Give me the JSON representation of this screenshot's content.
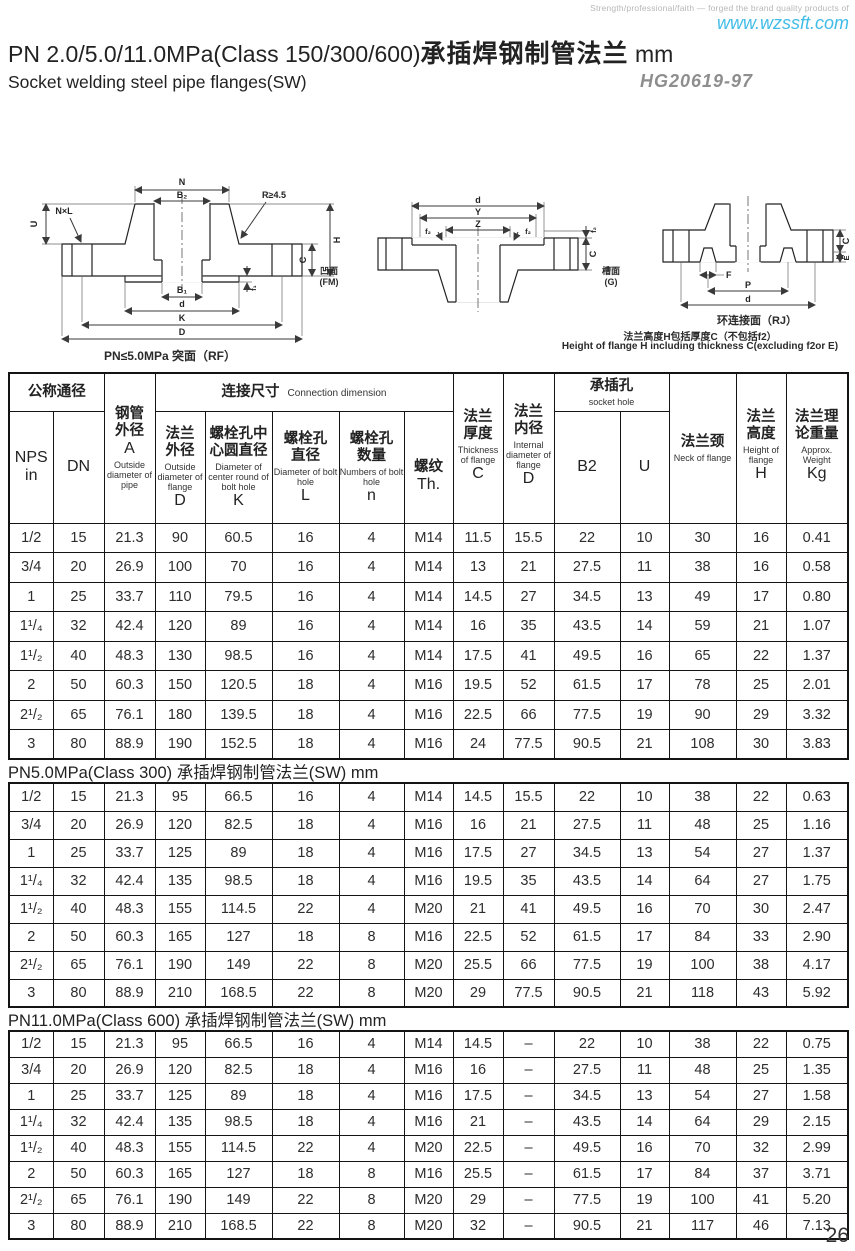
{
  "page": {
    "tagline": "Strength/professional/faith — forged the brand quality products of",
    "website": "www.wzssft.com",
    "title_en": "PN 2.0/5.0/11.0MPa(Class 150/300/600)",
    "title_cn": "承插焊钢制管法兰",
    "title_suffix": " mm",
    "subtitle": "Socket welding steel pipe flanges(SW)",
    "standard": "HG20619-97",
    "page_number": "26"
  },
  "colors": {
    "accent": "#41bce8",
    "muted": "#8e8e8e",
    "ink": "#262626"
  },
  "diagrams": {
    "rf": {
      "caption": "PN≤5.0MPa 突面（RF）",
      "dims": {
        "n": "N",
        "b2": "B₂",
        "nxl": "N×L",
        "r": "R≥4.5",
        "u": "U",
        "h": "H",
        "c": "C",
        "f1": "f₁",
        "b1": "B₁",
        "d": "d",
        "k": "K",
        "dd": "D"
      }
    },
    "fmg": {
      "dims": {
        "d": "d",
        "y": "Y",
        "z": "Z",
        "f2": "f₂",
        "c": "C"
      },
      "left_face_cn": "凹面",
      "left_face_code": "(FM)",
      "right_face_cn": "槽面",
      "right_face_code": "(G)"
    },
    "rj": {
      "caption": "环连接面（RJ）",
      "dims": {
        "c": "C",
        "e": "E",
        "f": "F",
        "p": "P",
        "d": "d"
      },
      "note_cn": "法兰高度H包括厚度C（不包括f2）",
      "note_en": "Height of flange H including thickness C(excluding f2or E)"
    }
  },
  "table": {
    "header": {
      "nominal_cn": "公称通径",
      "nps_l1": "NPS",
      "nps_l2": "in",
      "dn": "DN",
      "pipe_cn": "钢管\n外径",
      "pipe_letter": "A",
      "pipe_en": "Outside diameter of pipe",
      "conn_cn": "连接尺寸",
      "conn_en": "Connection dimension",
      "d_cn": "法兰\n外径",
      "d_en": "Outside diameter of flange",
      "d_letter": "D",
      "k_cn": "螺栓孔中\n心圆直径",
      "k_en": "Diameter of center round of bolt hole",
      "k_letter": "K",
      "l_cn": "螺栓孔\n直径",
      "l_en": "Diameter of bolt hole",
      "l_letter": "L",
      "n_cn": "螺栓孔\n数量",
      "n_en": "Numbers of bolt hole",
      "n_letter": "n",
      "th_cn": "螺纹",
      "th_letter": "Th.",
      "c_cn": "法兰\n厚度",
      "c_en": "Thickness of flange",
      "c_letter": "C",
      "id_cn": "法兰\n内径",
      "id_en": "Internal diameter of flange",
      "id_letter": "D",
      "socket_cn": "承插孔",
      "socket_en": "socket hole",
      "b2": "B2",
      "u": "U",
      "neck_cn": "法兰颈",
      "neck_en": "Neck of flange",
      "h_cn": "法兰\n高度",
      "h_en": "Height of flange",
      "h_letter": "H",
      "w_cn": "法兰理\n论重量",
      "w_en": "Approx. Weight",
      "w_letter": "Kg"
    },
    "sections": [
      {
        "title": "",
        "rows": [
          [
            "1/2",
            "15",
            "21.3",
            "90",
            "60.5",
            "16",
            "4",
            "M14",
            "11.5",
            "15.5",
            "22",
            "10",
            "30",
            "16",
            "0.41"
          ],
          [
            "3/4",
            "20",
            "26.9",
            "100",
            "70",
            "16",
            "4",
            "M14",
            "13",
            "21",
            "27.5",
            "11",
            "38",
            "16",
            "0.58"
          ],
          [
            "1",
            "25",
            "33.7",
            "110",
            "79.5",
            "16",
            "4",
            "M14",
            "14.5",
            "27",
            "34.5",
            "13",
            "49",
            "17",
            "0.80"
          ],
          [
            "1¹/₄",
            "32",
            "42.4",
            "120",
            "89",
            "16",
            "4",
            "M14",
            "16",
            "35",
            "43.5",
            "14",
            "59",
            "21",
            "1.07"
          ],
          [
            "1¹/₂",
            "40",
            "48.3",
            "130",
            "98.5",
            "16",
            "4",
            "M14",
            "17.5",
            "41",
            "49.5",
            "16",
            "65",
            "22",
            "1.37"
          ],
          [
            "2",
            "50",
            "60.3",
            "150",
            "120.5",
            "18",
            "4",
            "M16",
            "19.5",
            "52",
            "61.5",
            "17",
            "78",
            "25",
            "2.01"
          ],
          [
            "2¹/₂",
            "65",
            "76.1",
            "180",
            "139.5",
            "18",
            "4",
            "M16",
            "22.5",
            "66",
            "77.5",
            "19",
            "90",
            "29",
            "3.32"
          ],
          [
            "3",
            "80",
            "88.9",
            "190",
            "152.5",
            "18",
            "4",
            "M16",
            "24",
            "77.5",
            "90.5",
            "21",
            "108",
            "30",
            "3.83"
          ]
        ]
      },
      {
        "title": "PN5.0MPa(Class 300) 承插焊钢制管法兰(SW)  mm",
        "rows": [
          [
            "1/2",
            "15",
            "21.3",
            "95",
            "66.5",
            "16",
            "4",
            "M14",
            "14.5",
            "15.5",
            "22",
            "10",
            "38",
            "22",
            "0.63"
          ],
          [
            "3/4",
            "20",
            "26.9",
            "120",
            "82.5",
            "18",
            "4",
            "M16",
            "16",
            "21",
            "27.5",
            "11",
            "48",
            "25",
            "1.16"
          ],
          [
            "1",
            "25",
            "33.7",
            "125",
            "89",
            "18",
            "4",
            "M16",
            "17.5",
            "27",
            "34.5",
            "13",
            "54",
            "27",
            "1.37"
          ],
          [
            "1¹/₄",
            "32",
            "42.4",
            "135",
            "98.5",
            "18",
            "4",
            "M16",
            "19.5",
            "35",
            "43.5",
            "14",
            "64",
            "27",
            "1.75"
          ],
          [
            "1¹/₂",
            "40",
            "48.3",
            "155",
            "114.5",
            "22",
            "4",
            "M20",
            "21",
            "41",
            "49.5",
            "16",
            "70",
            "30",
            "2.47"
          ],
          [
            "2",
            "50",
            "60.3",
            "165",
            "127",
            "18",
            "8",
            "M16",
            "22.5",
            "52",
            "61.5",
            "17",
            "84",
            "33",
            "2.90"
          ],
          [
            "2¹/₂",
            "65",
            "76.1",
            "190",
            "149",
            "22",
            "8",
            "M20",
            "25.5",
            "66",
            "77.5",
            "19",
            "100",
            "38",
            "4.17"
          ],
          [
            "3",
            "80",
            "88.9",
            "210",
            "168.5",
            "22",
            "8",
            "M20",
            "29",
            "77.5",
            "90.5",
            "21",
            "118",
            "43",
            "5.92"
          ]
        ]
      },
      {
        "title": "PN11.0MPa(Class 600) 承插焊钢制管法兰(SW)  mm",
        "rows": [
          [
            "1/2",
            "15",
            "21.3",
            "95",
            "66.5",
            "16",
            "4",
            "M14",
            "14.5",
            "–",
            "22",
            "10",
            "38",
            "22",
            "0.75"
          ],
          [
            "3/4",
            "20",
            "26.9",
            "120",
            "82.5",
            "18",
            "4",
            "M16",
            "16",
            "–",
            "27.5",
            "11",
            "48",
            "25",
            "1.35"
          ],
          [
            "1",
            "25",
            "33.7",
            "125",
            "89",
            "18",
            "4",
            "M16",
            "17.5",
            "–",
            "34.5",
            "13",
            "54",
            "27",
            "1.58"
          ],
          [
            "1¹/₄",
            "32",
            "42.4",
            "135",
            "98.5",
            "18",
            "4",
            "M16",
            "21",
            "–",
            "43.5",
            "14",
            "64",
            "29",
            "2.15"
          ],
          [
            "1¹/₂",
            "40",
            "48.3",
            "155",
            "114.5",
            "22",
            "4",
            "M20",
            "22.5",
            "–",
            "49.5",
            "16",
            "70",
            "32",
            "2.99"
          ],
          [
            "2",
            "50",
            "60.3",
            "165",
            "127",
            "18",
            "8",
            "M16",
            "25.5",
            "–",
            "61.5",
            "17",
            "84",
            "37",
            "3.71"
          ],
          [
            "2¹/₂",
            "65",
            "76.1",
            "190",
            "149",
            "22",
            "8",
            "M20",
            "29",
            "–",
            "77.5",
            "19",
            "100",
            "41",
            "5.20"
          ],
          [
            "3",
            "80",
            "88.9",
            "210",
            "168.5",
            "22",
            "8",
            "M20",
            "32",
            "–",
            "90.5",
            "21",
            "117",
            "46",
            "7.13"
          ]
        ]
      }
    ]
  }
}
